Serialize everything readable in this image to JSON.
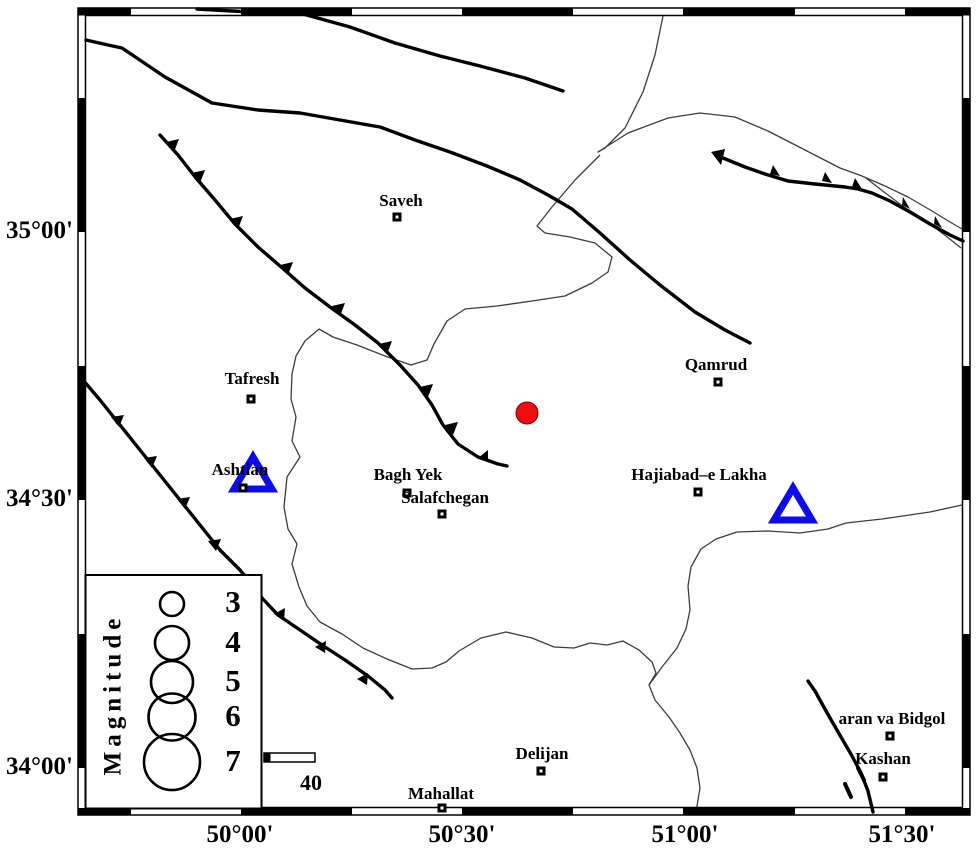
{
  "map": {
    "kind": "seismicity-map",
    "axes": {
      "lat_labels": [
        "35°00'",
        "34°30'",
        "34°00'"
      ],
      "lon_labels": [
        "50°00'",
        "50°30'",
        "51°00'",
        "51°30'"
      ]
    },
    "cities": [
      "Saveh",
      "Tafresh",
      "Ashtian",
      "Bagh Yek",
      "Salafchegan",
      "Qamrud",
      "Hajiabad–e Lakha",
      "Delijan",
      "Mahallat",
      "aran va Bidgol",
      "Kashan"
    ],
    "legend": {
      "title": "Magnitude",
      "values": [
        "3",
        "4",
        "5",
        "6",
        "7"
      ]
    },
    "scale_bar": {
      "label": "40"
    },
    "symbols": {
      "epicenter": "red-filled-circle",
      "station": "blue-open-triangle",
      "city": "square-marker",
      "fault": "thick-black-line",
      "thrust_fault": "thick-black-line-with-teeth",
      "boundary": "thin-line"
    },
    "colors": {
      "epicenter_fill": "#f20d0d",
      "epicenter_edge": "#7a0000",
      "station_stroke": "#0b0bf2",
      "fault": "#000000",
      "boundary": "#3d3d3d"
    }
  }
}
